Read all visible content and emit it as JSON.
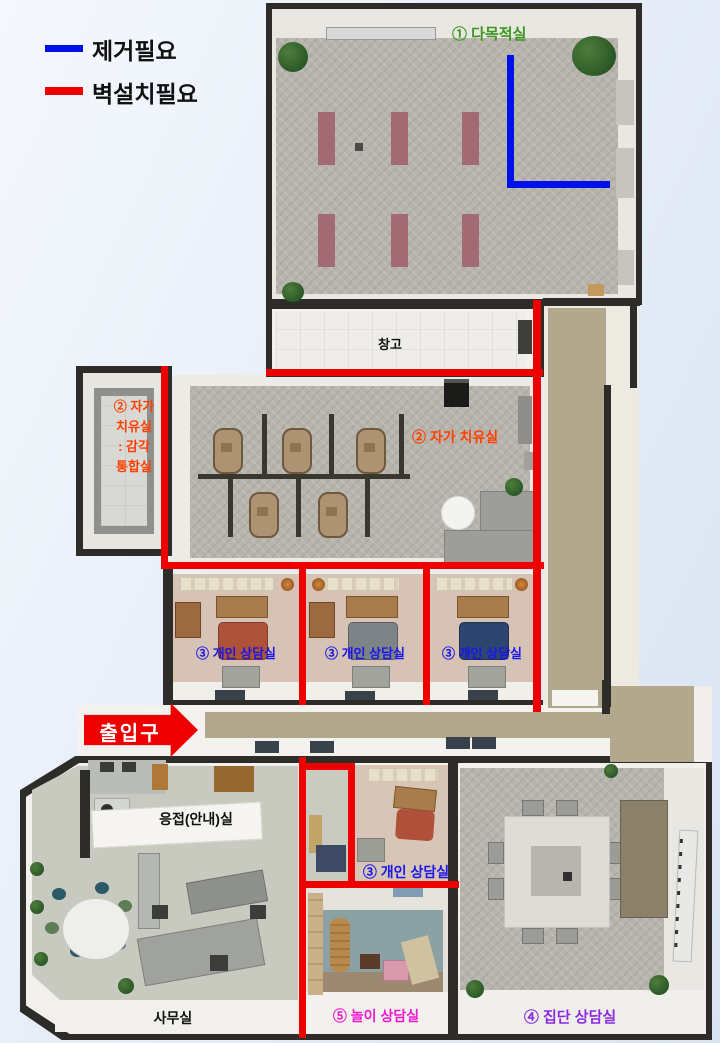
{
  "legend": {
    "items": [
      {
        "id": "remove",
        "label": "제거필요",
        "color": "#0010e8"
      },
      {
        "id": "install-wall",
        "label": "벽설치필요",
        "color": "#ee0000"
      }
    ]
  },
  "entrance": {
    "label": "출입구",
    "text_color": "#ffffff",
    "arrow_color": "#ee0000"
  },
  "rooms": {
    "multipurpose": {
      "label": "① 다목적실",
      "label_color": "#3c9620"
    },
    "storage": {
      "label": "창고",
      "label_color": "#111111"
    },
    "sensory_integration": {
      "lines": [
        "② 자가",
        "치유실",
        ": 감각",
        "통합실"
      ],
      "label_color": "#ff4000"
    },
    "self_healing": {
      "label": "② 자가 치유실",
      "label_color": "#ff4000"
    },
    "counseling_row": {
      "labels": [
        "③ 개인 상담실",
        "③ 개인 상담실",
        "③ 개인 상담실"
      ],
      "label_color": "#1a16e8"
    },
    "reception": {
      "label": "응접(안내)실",
      "label_color": "#111111"
    },
    "counseling_small": {
      "label": "③ 개인 상담실",
      "label_color": "#1a16e8"
    },
    "office": {
      "label": "사무실",
      "label_color": "#111111"
    },
    "play": {
      "label": "⑤ 놀이 상담실",
      "label_color": "#f018d0"
    },
    "group": {
      "label": "④ 집단 상담실",
      "label_color": "#8a2be2"
    }
  },
  "annotation_colors": {
    "wall": "#2d2c28",
    "remove_line": "#0010e8",
    "install_line": "#ee0000"
  }
}
